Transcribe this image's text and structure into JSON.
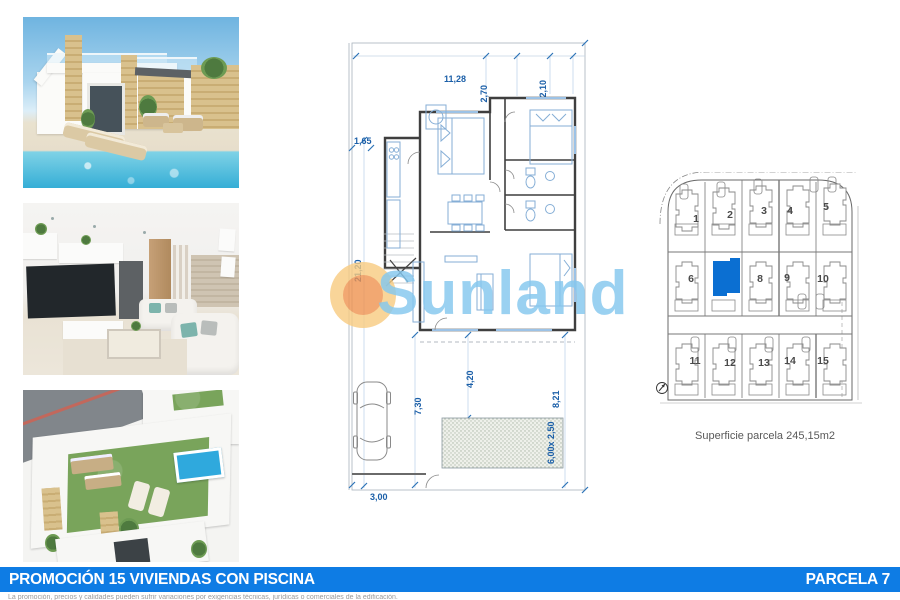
{
  "banner": {
    "title": "PROMOCIÓN 15 VIVIENDAS CON PISCINA",
    "parcel_label": "PARCELA 7",
    "color": "#0e7ce4"
  },
  "disclaimer": "La promoción, precios y calidades pueden sufrir variaciones por exigencias técnicas, jurídicas o comerciales de la edificación.",
  "watermark": {
    "brand": "Sunland"
  },
  "floor_plan": {
    "dim_top_width": "11,28",
    "dim_top_seg1": "2,70",
    "dim_top_seg2": "2,10",
    "dim_left_setback": "1,65",
    "dim_left_depth": "21,20",
    "dim_garden_left": "7,30",
    "dim_garden_mid": "4,20",
    "dim_garden_right": "8,21",
    "pool_size": "6,00x 2,50",
    "dim_bottom": "3,00"
  },
  "site_plan": {
    "highlighted_parcel": "7",
    "highlight_color": "#0b6fd2",
    "caption": "Superficie parcela 245,15m2",
    "parcels": [
      "1",
      "2",
      "3",
      "4",
      "5",
      "6",
      "8",
      "9",
      "10",
      "11",
      "12",
      "13",
      "14",
      "15"
    ]
  }
}
